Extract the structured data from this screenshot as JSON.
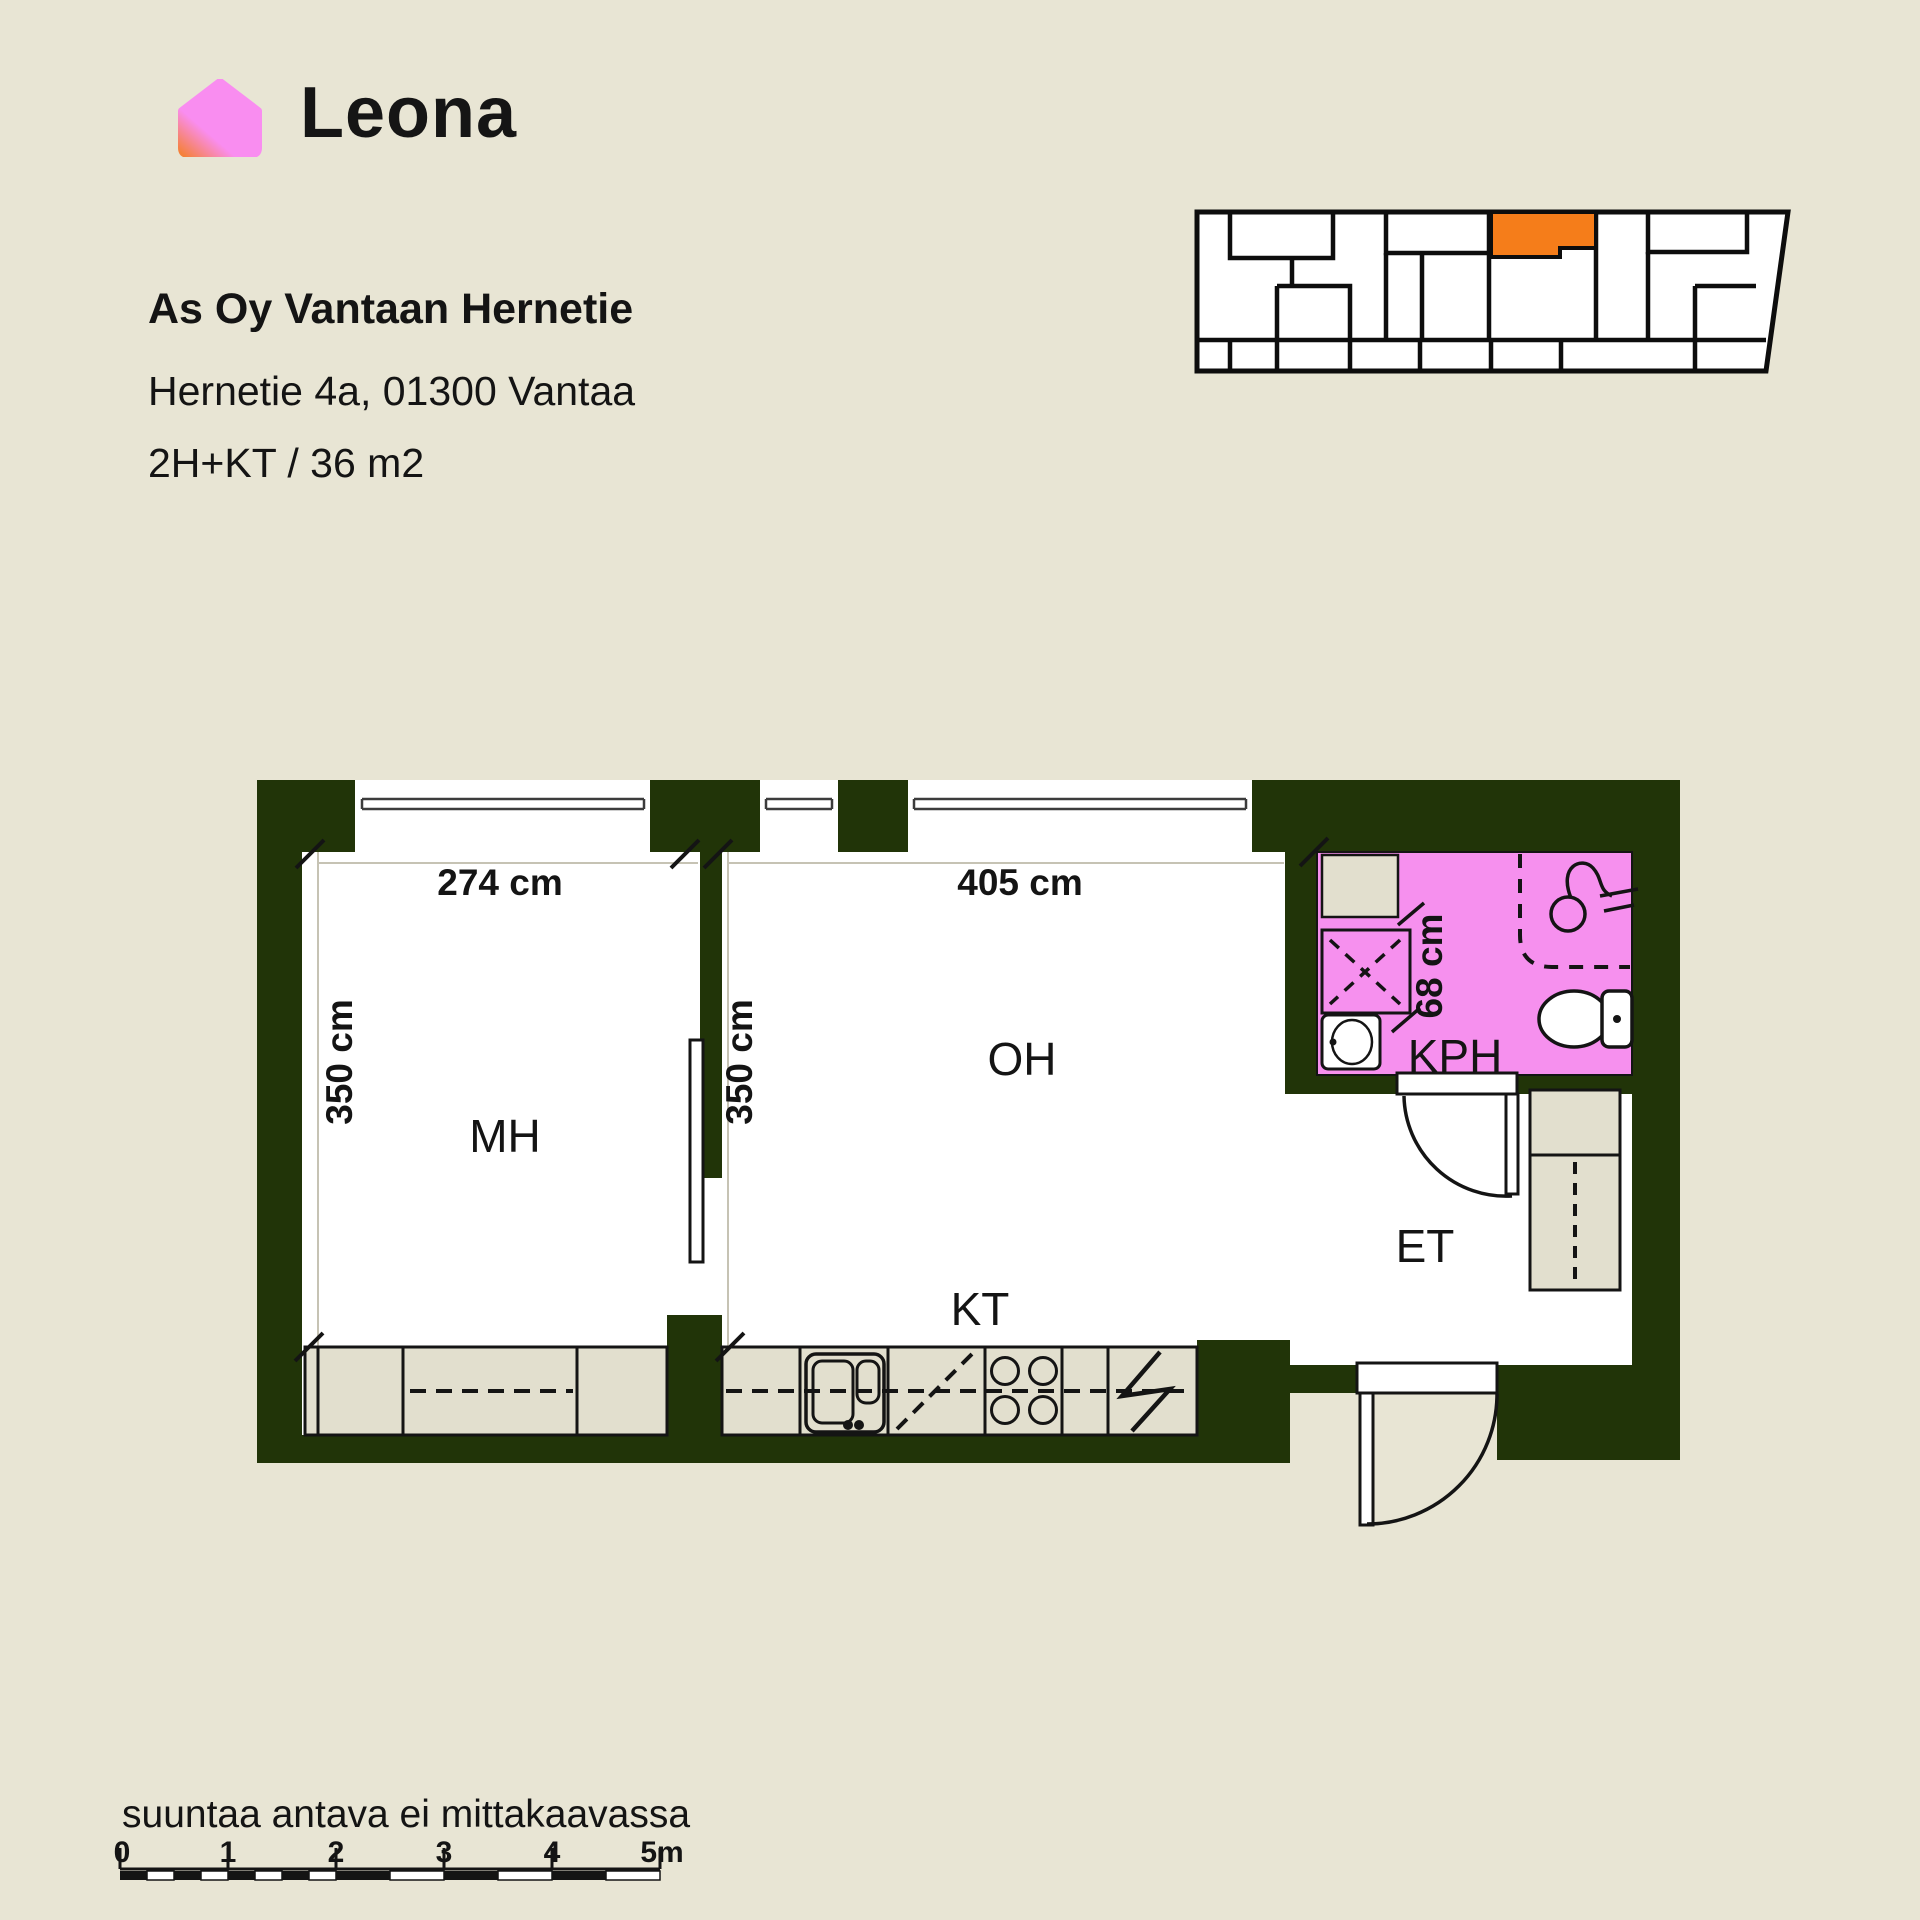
{
  "brand": {
    "logo_text": "Leona",
    "logo_icon": "house-icon",
    "logo_pink": "#f98df0",
    "logo_orange": "#f5813a"
  },
  "listing": {
    "title": "As Oy Vantaan Hernetie",
    "address": "Hernetie 4a, 01300 Vantaa",
    "apartment_type": "2H+KT / 36 m2"
  },
  "site_plan": {
    "highlight_color": "#f57d1a",
    "description": "building outline with highlighted unit"
  },
  "floor_plan": {
    "wall_color": "#213408",
    "bathroom_color": "#f690ee",
    "fixture_color": "#e2dfce",
    "floor_color": "#ffffff",
    "rooms": {
      "bedroom": {
        "label": "MH",
        "width_label": "274 cm",
        "height_label": "350 cm"
      },
      "living": {
        "label": "OH",
        "width_label": "405 cm",
        "height_label": "350 cm"
      },
      "kitchen": {
        "label": "KT"
      },
      "bathroom": {
        "label": "KPH",
        "shower_width_label": "68 cm"
      },
      "entry": {
        "label": "ET"
      }
    }
  },
  "footer": {
    "disclaimer": "suuntaa antava ei mittakaavassa",
    "scale_ticks": [
      "0",
      "1",
      "2",
      "3",
      "4",
      "5m"
    ]
  }
}
